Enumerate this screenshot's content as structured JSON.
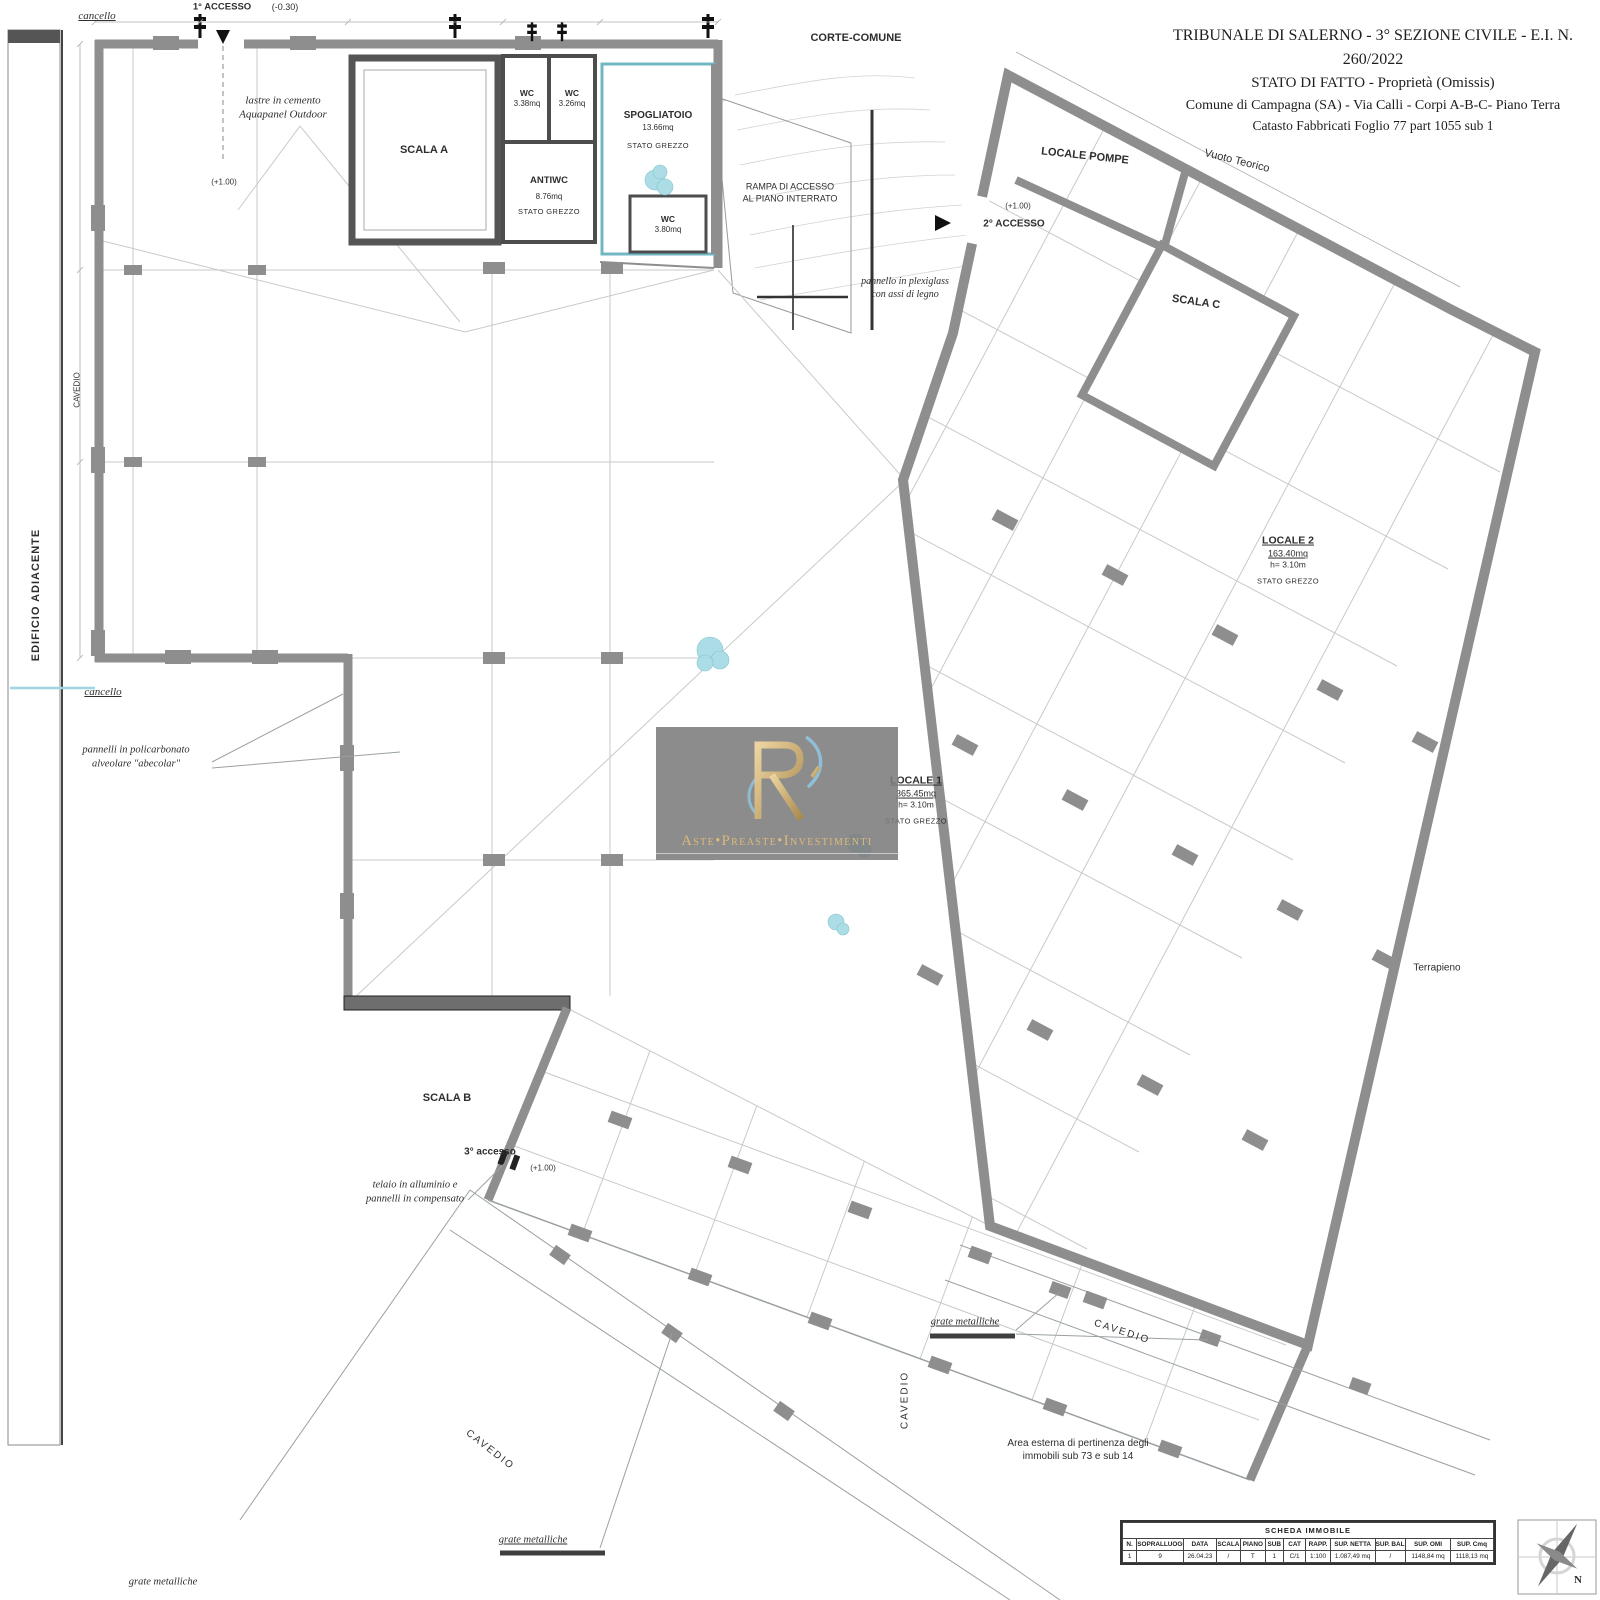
{
  "title_block": {
    "line1": "TRIBUNALE DI SALERNO - 3° SEZIONE CIVILE - E.I. N. 260/2022",
    "line2": "STATO DI FATTO - Proprietà (Omissis)",
    "line3": "Comune di Campagna (SA) - Via Calli - Corpi A-B-C- Piano Terra",
    "line4": "Catasto Fabbricati Foglio 77 part 1055 sub 1"
  },
  "site": {
    "corte_comune": "CORTE-COMUNE",
    "vuoto_teorico": "Vuoto Teorico",
    "terrapieno": "Terrapieno",
    "edificio_adiacente": "EDIFICIO ADIACENTE",
    "cavedio": "CAVEDIO",
    "cancello": "cancello",
    "area_esterna_1": "Area esterna di pertinenza degli",
    "area_esterna_2": "immobili sub 73 e sub 14",
    "grate_metalliche": "grate metalliche"
  },
  "access": {
    "a1": "1° ACCESSO",
    "a1_quota": "(-0.30)",
    "a2": "2° ACCESSO",
    "a2_quota": "(+1.00)",
    "a3": "3° accesso",
    "a3_quota": "(+1.00)",
    "quota_int": "(+1.00)"
  },
  "annotations": {
    "lastre_1": "lastre in cemento",
    "lastre_2": "Aquapanel Outdoor",
    "plexi_1": "pannello in plexiglass",
    "plexi_2": "con assi di legno",
    "poli_1": "pannelli in policarbonato",
    "poli_2": "alveolare \"abecolar\"",
    "telaio_1": "telaio in alluminio e",
    "telaio_2": "pannelli in compensato",
    "rampa_1": "RAMPA DI ACCESSO",
    "rampa_2": "AL PIANO INTERRATO"
  },
  "rooms": {
    "scala_a": "SCALA A",
    "scala_b": "SCALA B",
    "scala_c": "SCALA C",
    "locale_pompe": "LOCALE POMPE",
    "wc1_name": "WC",
    "wc1_area": "3.38mq",
    "wc2_name": "WC",
    "wc2_area": "3.26mq",
    "antiwc_name": "ANTIWC",
    "antiwc_area": "8.76mq",
    "antiwc_status": "STATO GREZZO",
    "spog_name": "SPOGLIATOIO",
    "spog_area": "13.66mq",
    "spog_status": "STATO GREZZO",
    "wc3_name": "WC",
    "wc3_area": "3.80mq",
    "locale1_name": "LOCALE 1",
    "locale1_area": "365.45mq",
    "locale1_h": "h= 3.10m",
    "locale1_status": "STATO GREZZO",
    "locale2_name": "LOCALE 2",
    "locale2_area": "163.40mq",
    "locale2_h": "h= 3.10m",
    "locale2_status": "STATO GREZZO"
  },
  "watermark": {
    "brand": "Aste•Preaste•Investimenti",
    "gold": "#d9b878",
    "blue": "#8fc3de"
  },
  "scheda": {
    "title": "SCHEDA IMMOBILE",
    "headers": [
      "N.",
      "SOPRALLUOGO",
      "DATA",
      "SCALA",
      "PIANO",
      "SUB",
      "CAT",
      "RAPP.",
      "SUP. NETTA",
      "SUP. BALC.",
      "SUP. OMI",
      "SUP. Cmq"
    ],
    "row": [
      "1",
      "9",
      "26.04.23",
      "/",
      "T",
      "1",
      "C/1",
      "1:100",
      "1.087,49 mq",
      "/",
      "1148,84 mq",
      "1118,13 mq"
    ]
  },
  "compass": {
    "north": "N"
  }
}
